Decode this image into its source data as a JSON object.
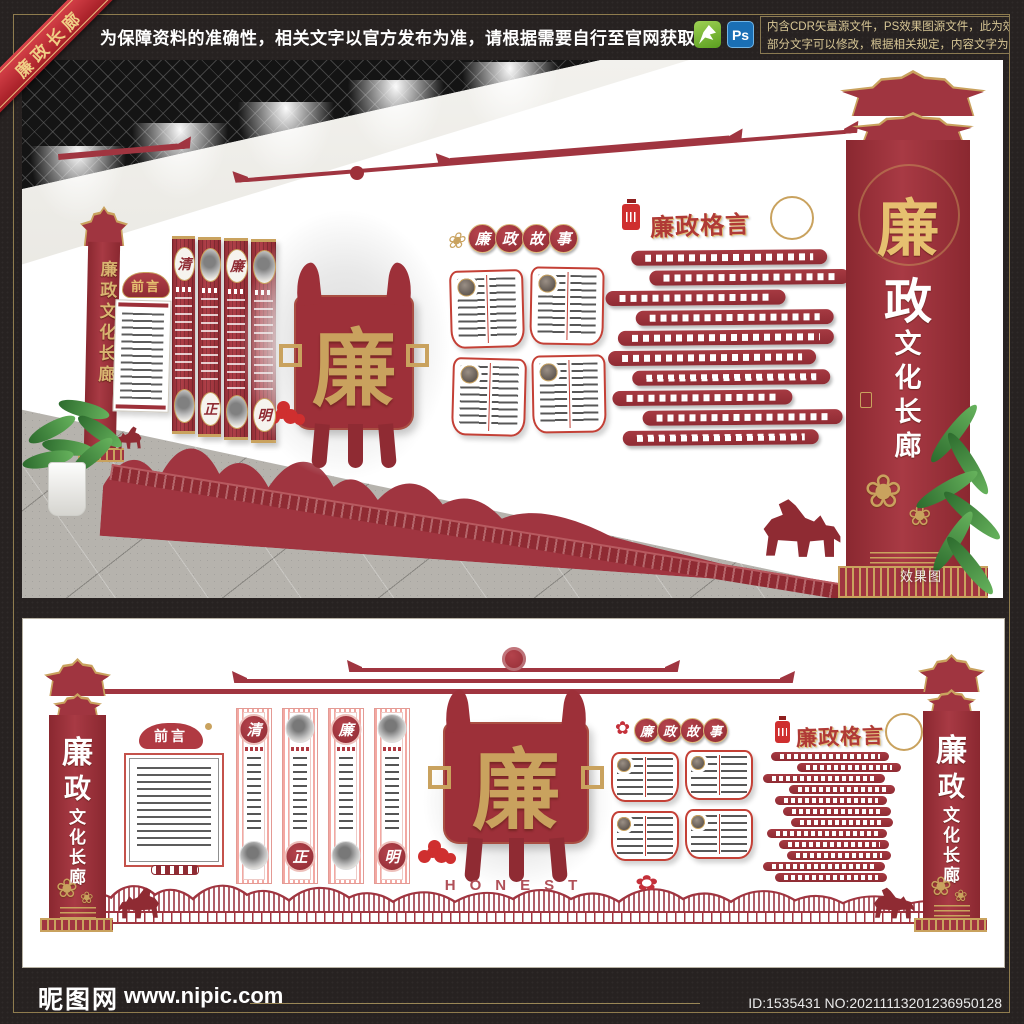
{
  "header": {
    "ribbon_label": "廉政长廊",
    "notice": "为保障资料的准确性，相关文字以官方发布为准，请根据需要自行至官网获取！",
    "ps_icon_label": "Ps",
    "note_line1": "内含CDR矢量源文件，PS效果图源文件，此为效果",
    "note_line2": "部分文字可以修改，根据相关规定，内容文字为色块！"
  },
  "wall": {
    "corridor_title": "廉政文化长廊",
    "pillar_chars": [
      "廉",
      "政",
      "文",
      "化",
      "长",
      "廊"
    ],
    "foreword_title": "前言",
    "scroll_chars": [
      "清",
      "正",
      "廉",
      "明"
    ],
    "emblem_char": "廉",
    "story_title": "廉政故事",
    "story_chars": [
      "廉",
      "政",
      "故",
      "事"
    ],
    "maxim_title": "廉政格言",
    "honest_label": "HONEST",
    "render_watermark": "效果图",
    "lotus_glyph": "❀",
    "lotus_glyph_red": "✿"
  },
  "footer": {
    "site_name": "昵图网",
    "site_url": "www.nipic.com",
    "image_id": "ID:1535431 NO:20211113201236950128"
  },
  "colors": {
    "dark_red": "#9d3039",
    "deep_red": "#8f2b33",
    "bright_red": "#c0392f",
    "gold": "#c9a25e",
    "pink": "#f0a39d",
    "frame_gold": "#8f7c4e",
    "ps_blue": "#1a6fb5",
    "cdr_green": "#6fae2c",
    "dark_bg": "#272221"
  }
}
